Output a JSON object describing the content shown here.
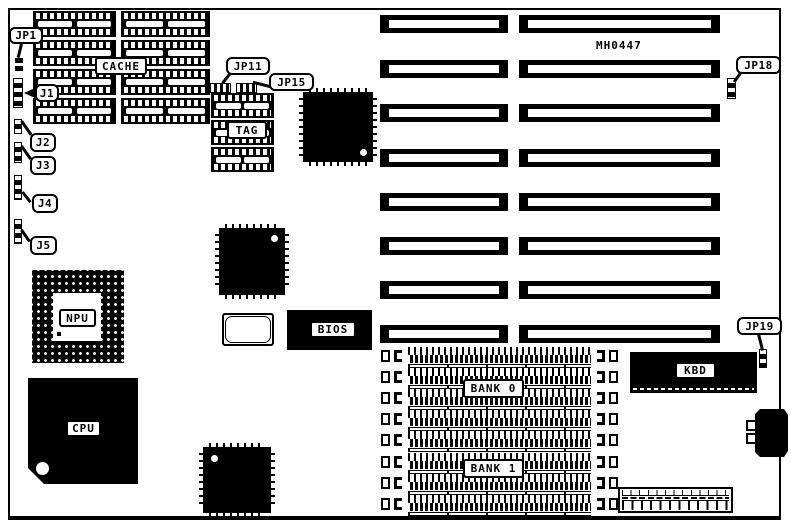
{
  "board": {
    "part_number": "MH0447",
    "colors": {
      "ink": "#000000",
      "paper": "#ffffff"
    }
  },
  "components": {
    "cache": {
      "label": "CACHE",
      "columns": 2,
      "chips_per_column": 4
    },
    "tag": {
      "label": "TAG",
      "chips": 3
    },
    "npu": {
      "label": "NPU"
    },
    "cpu": {
      "label": "CPU"
    },
    "bios": {
      "label": "BIOS"
    },
    "kbd": {
      "label": "KBD"
    },
    "memory": {
      "simm_rows": 8,
      "banks": [
        {
          "label": "BANK 0"
        },
        {
          "label": "BANK 1"
        }
      ]
    },
    "expansion_slots": {
      "rows": 8,
      "columns": 2
    }
  },
  "jumpers": [
    {
      "id": "jp1",
      "label": "JP1"
    },
    {
      "id": "j1",
      "label": "J1"
    },
    {
      "id": "j2",
      "label": "J2"
    },
    {
      "id": "j3",
      "label": "J3"
    },
    {
      "id": "j4",
      "label": "J4"
    },
    {
      "id": "j5",
      "label": "J5"
    },
    {
      "id": "jp11",
      "label": "JP11"
    },
    {
      "id": "jp15",
      "label": "JP15"
    },
    {
      "id": "jp18",
      "label": "JP18"
    },
    {
      "id": "jp19",
      "label": "JP19"
    }
  ]
}
